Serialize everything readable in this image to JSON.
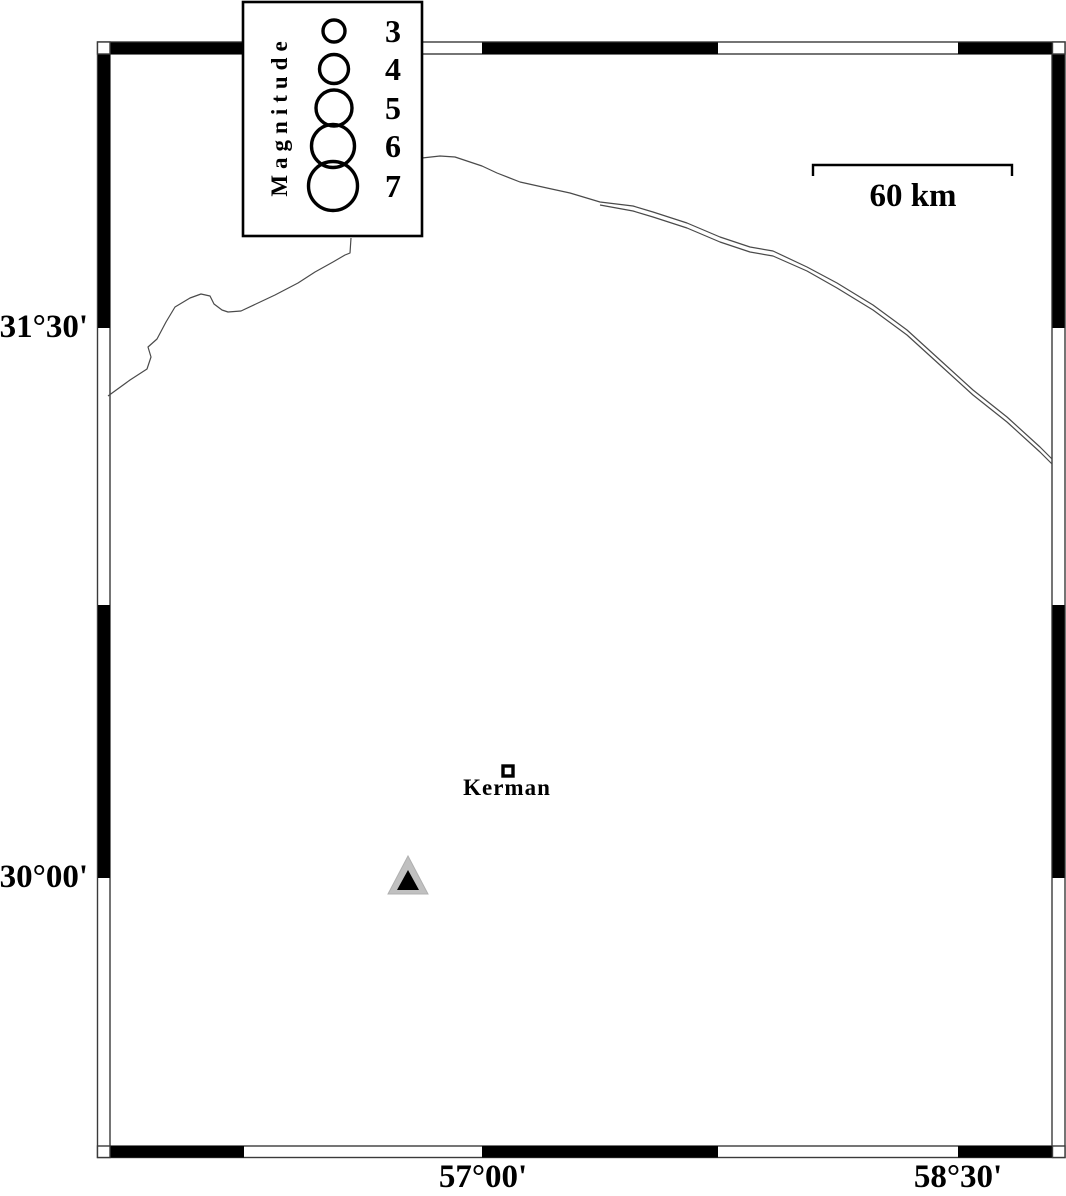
{
  "title": "Seismotectonic map of the Kerman region",
  "axis": {
    "lat_top": "31°30'",
    "lat_bottom": "30°00'",
    "lon_left": "57°00'",
    "lon_right": "58°30'"
  },
  "legend": {
    "title": "Magnitude",
    "magnitudes": [
      "3",
      "4",
      "5",
      "6",
      "7"
    ],
    "circle_radii_px": [
      11,
      14.5,
      18,
      21.5,
      24.5
    ]
  },
  "scale_bar": {
    "label": "60 km",
    "length_px": 199
  },
  "city": {
    "name": "Kerman",
    "marker": "open-square"
  },
  "station": {
    "marker": "triangle",
    "fill": "#c0c0c0",
    "inner_fill": "#000000"
  },
  "colors": {
    "ink": "#000000",
    "frame_outline": "#3a3a3a",
    "road_line": "#4a4a4a",
    "background": "#ffffff"
  }
}
